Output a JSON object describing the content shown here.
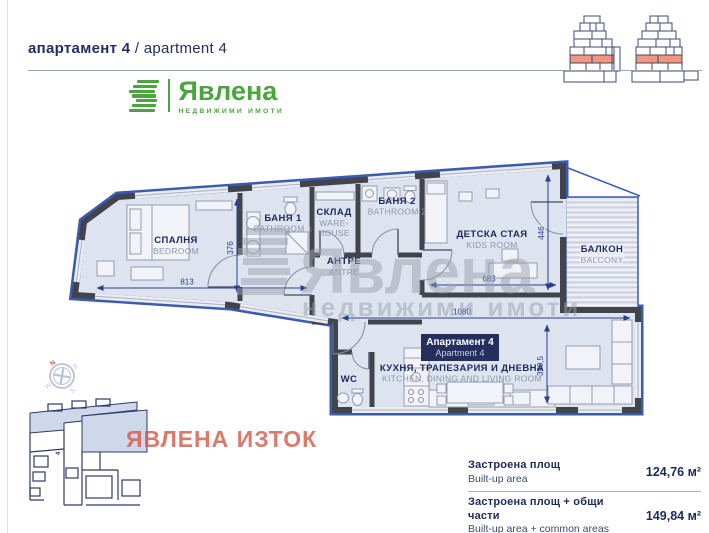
{
  "header": {
    "title_bg": "апартамент 4",
    "title_en": "/ apartment 4"
  },
  "logo": {
    "name": "Явлена",
    "tagline": "НЕДВИЖИМИ ИМОТИ"
  },
  "watermark": {
    "name": "Явлена",
    "tagline": "недвижими имоти"
  },
  "site_overlay": {
    "label": "ЯВЛЕНА ИЗТОК"
  },
  "keyplan": {
    "unit": "4"
  },
  "compass": {
    "n": "N",
    "e": "E",
    "s": "S",
    "w": "W"
  },
  "plan": {
    "apartment_box": {
      "line1": "Апартамент 4",
      "line2": "Apartment 4"
    },
    "rooms": {
      "bedroom": {
        "bg": "СПАЛНЯ",
        "en": "BEDROOM"
      },
      "bathroom1": {
        "bg": "БАНЯ 1",
        "en": "BATHROOM 1"
      },
      "storage": {
        "bg": "СКЛАД",
        "en1": "WARE-",
        "en2": "HOUSE"
      },
      "bathroom2": {
        "bg": "БАНЯ 2",
        "en": "BATHROOM 2"
      },
      "kidsroom": {
        "bg": "ДЕТСКА СТАЯ",
        "en": "KIDS ROOM"
      },
      "hall": {
        "bg": "АНТРЕ",
        "en": "ANTRE"
      },
      "balcony": {
        "bg": "БАЛКОН",
        "en": "BALCONY"
      },
      "wc": {
        "bg": "WC"
      },
      "kitchen": {
        "bg": "КУХНЯ, ТРАПЕЗАРИЯ И ДНЕВНА",
        "en": "KITCHEN, DINING AND LIVING ROOM"
      }
    },
    "dimensions": {
      "bedroom_w": "813",
      "bedroom_h": "376",
      "kids_w": "683",
      "kids_h": "446",
      "living_w": "1080",
      "living_h": "399,5"
    }
  },
  "areas": {
    "rows": [
      {
        "label_bg": "Застроена площ",
        "label_en": "Built-up area",
        "value": "124,76 м²"
      },
      {
        "label_bg": "Застроена площ + общи части",
        "label_en": "Built-up area + common areas",
        "value": "149,84 м²"
      }
    ]
  },
  "page": {
    "number": "017"
  },
  "colors": {
    "navy": "#1e2a5a",
    "accent_green": "#4aa63c",
    "plan_blue": "#3a5ab5",
    "salmon_highlight": "#f0977c",
    "watermark_gray": "#9aa0ac",
    "site_label_red": "#d65c49"
  }
}
